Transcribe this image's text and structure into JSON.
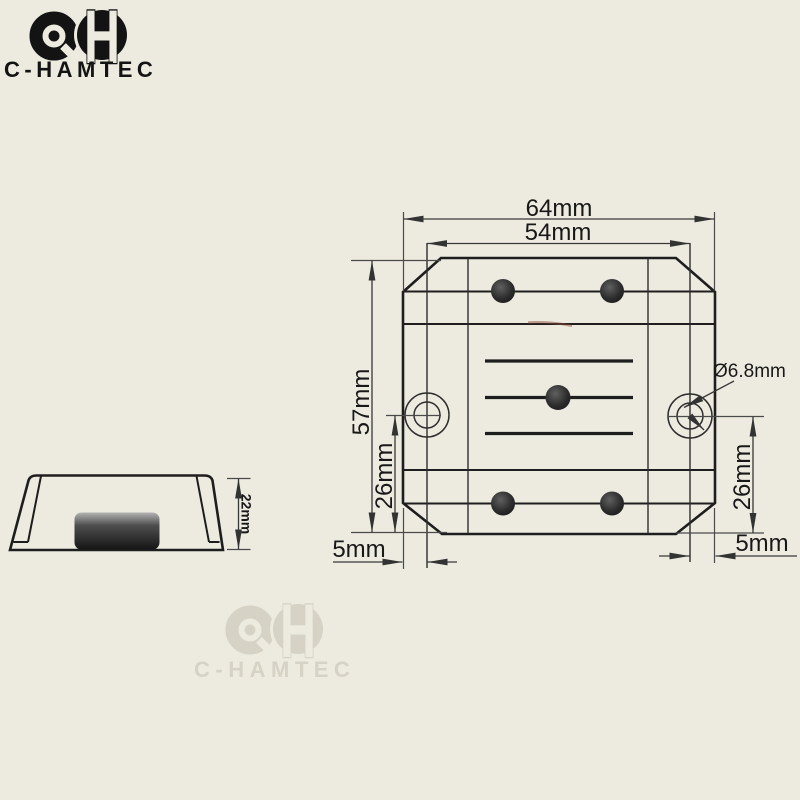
{
  "page": {
    "background": "#edebe0"
  },
  "brand": {
    "name": "C-HAMTEC",
    "monogram_letter": "H",
    "ink": "#131313",
    "watermark_color": "#d6d3c6"
  },
  "drawing": {
    "line_color": "#1e1e1e",
    "dimension_color": "#383838",
    "top_view": {
      "overall_width": "64mm",
      "hole_span_width": "54mm",
      "overall_height": "57mm",
      "hole_to_base_left": "26mm",
      "hole_to_base_right": "26mm",
      "edge_to_hole_left": "5mm",
      "edge_to_hole_right": "5mm",
      "hole_diameter": "Ø6.8mm"
    },
    "side_view": {
      "overall_height": "22mm"
    }
  }
}
